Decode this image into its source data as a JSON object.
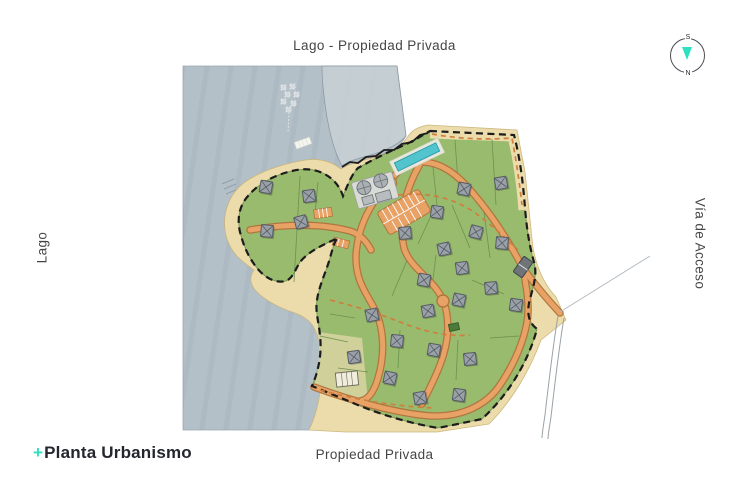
{
  "header": {
    "title": "Lago - Propiedad Privada"
  },
  "sides": {
    "left_label": "Lago",
    "right_label": "Vía de Acceso",
    "bottom_label": "Propiedad Privada"
  },
  "footer_logo": {
    "plus": "+",
    "name": "Planta Urbanismo"
  },
  "compass": {
    "top_letter": "S",
    "bottom_letter": "N"
  },
  "colors": {
    "accent_mint": "#2fe0c0",
    "lake": "#b4c0c8",
    "lake_light": "#c8d0d5",
    "beach": "#ecdcab",
    "green": "#99bb6d",
    "light_lots": "#d8d4a2",
    "road_fill": "#e9a266",
    "road_edge": "#b0763f",
    "trail": "#cf7f3e",
    "pool": "#52c4ce",
    "boundary": "#1c1c1c",
    "house": "#9aa0a8"
  },
  "map": {
    "house_count": 25,
    "houses": [
      [
        266,
        187,
        10
      ],
      [
        309,
        196,
        -8
      ],
      [
        267,
        231,
        5
      ],
      [
        301,
        222,
        -15
      ],
      [
        464,
        189,
        12
      ],
      [
        501,
        183,
        -10
      ],
      [
        437,
        212,
        8
      ],
      [
        405,
        233,
        -5
      ],
      [
        476,
        232,
        15
      ],
      [
        444,
        249,
        -12
      ],
      [
        502,
        243,
        5
      ],
      [
        462,
        268,
        -8
      ],
      [
        424,
        280,
        10
      ],
      [
        491,
        288,
        -5
      ],
      [
        459,
        300,
        12
      ],
      [
        428,
        311,
        -10
      ],
      [
        516,
        305,
        8
      ],
      [
        372,
        315,
        -12
      ],
      [
        397,
        341,
        6
      ],
      [
        354,
        357,
        -8
      ],
      [
        434,
        350,
        10
      ],
      [
        470,
        359,
        -6
      ],
      [
        390,
        378,
        12
      ],
      [
        420,
        398,
        -10
      ],
      [
        459,
        395,
        8
      ]
    ]
  }
}
